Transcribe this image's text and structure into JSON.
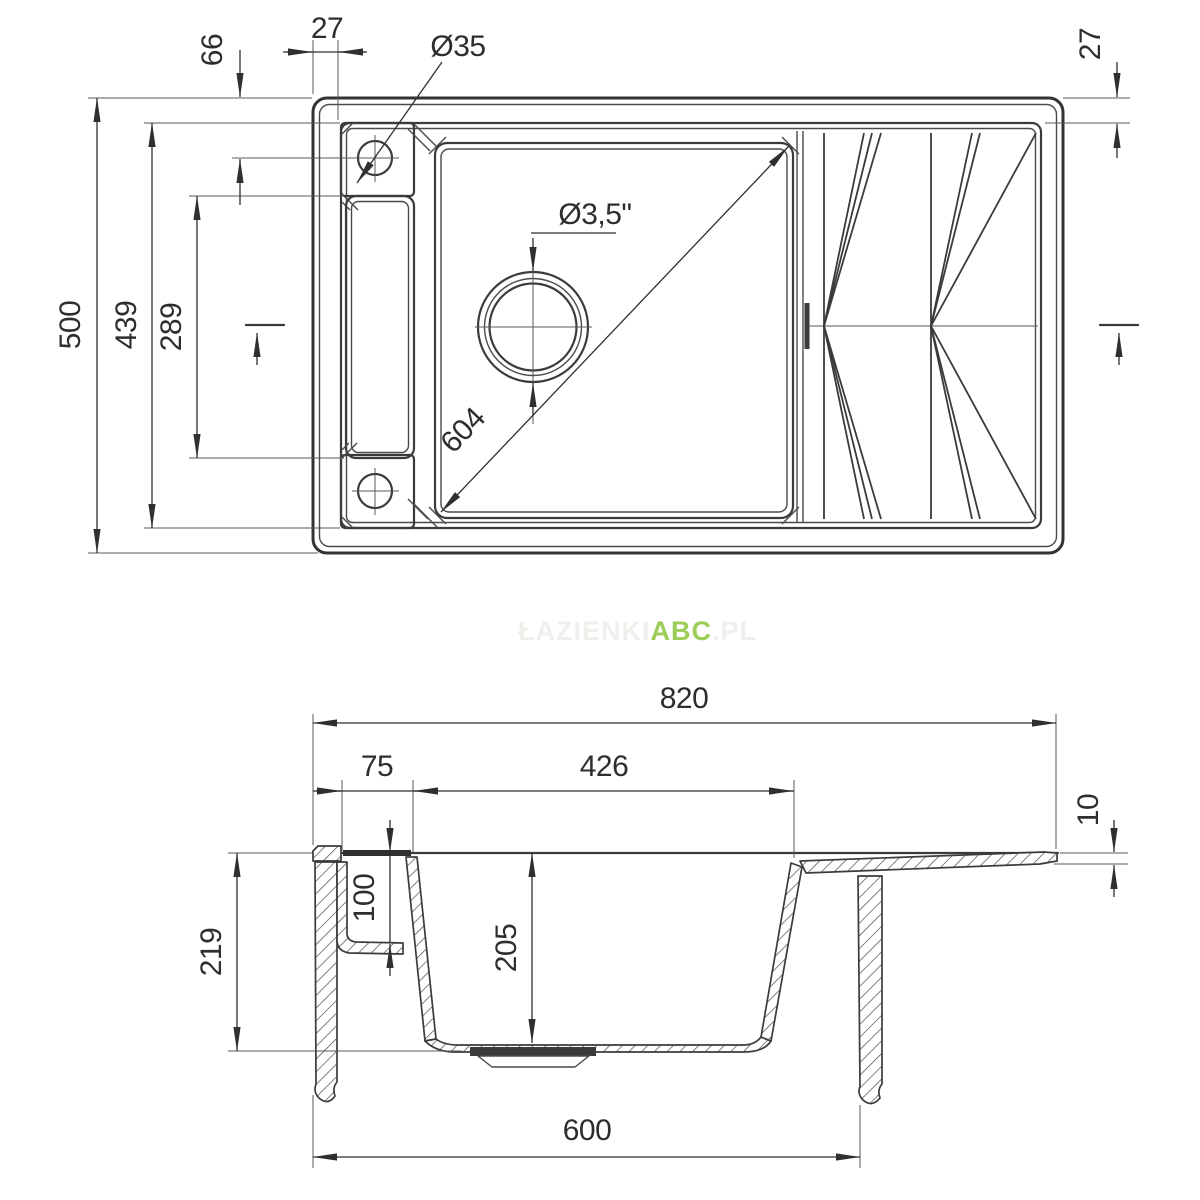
{
  "drawing": {
    "type": "kitchen-sink-technical-drawing",
    "views": [
      "top-view",
      "section-view"
    ]
  },
  "top_view": {
    "dims": {
      "overall_width": "500",
      "rim_width": "439",
      "channel_length": "289",
      "hole_edge_offset": "66",
      "rim_offset_top": "27",
      "rim_offset_right": "27",
      "tap_hole_diameter": "Ø35",
      "drain_diameter": "Ø3,5\"",
      "bowl_diagonal": "604"
    }
  },
  "section_view": {
    "dims": {
      "overall_length": "820",
      "deck_width": "75",
      "bowl_opening_width": "426",
      "board_edge_thickness": "10",
      "overall_depth": "219",
      "deck_pocket_depth": "100",
      "bowl_depth": "205",
      "cabinet_width": "600"
    }
  },
  "watermark": {
    "prefix": "ŁAZIENKI",
    "accent": "ABC",
    "suffix": ".PL",
    "accent_color": "#9bcd57",
    "faint_color": "#f0efec"
  },
  "colors": {
    "line": "#3b3b3b",
    "dimension_text": "#2e2e2e",
    "background": "#ffffff"
  }
}
